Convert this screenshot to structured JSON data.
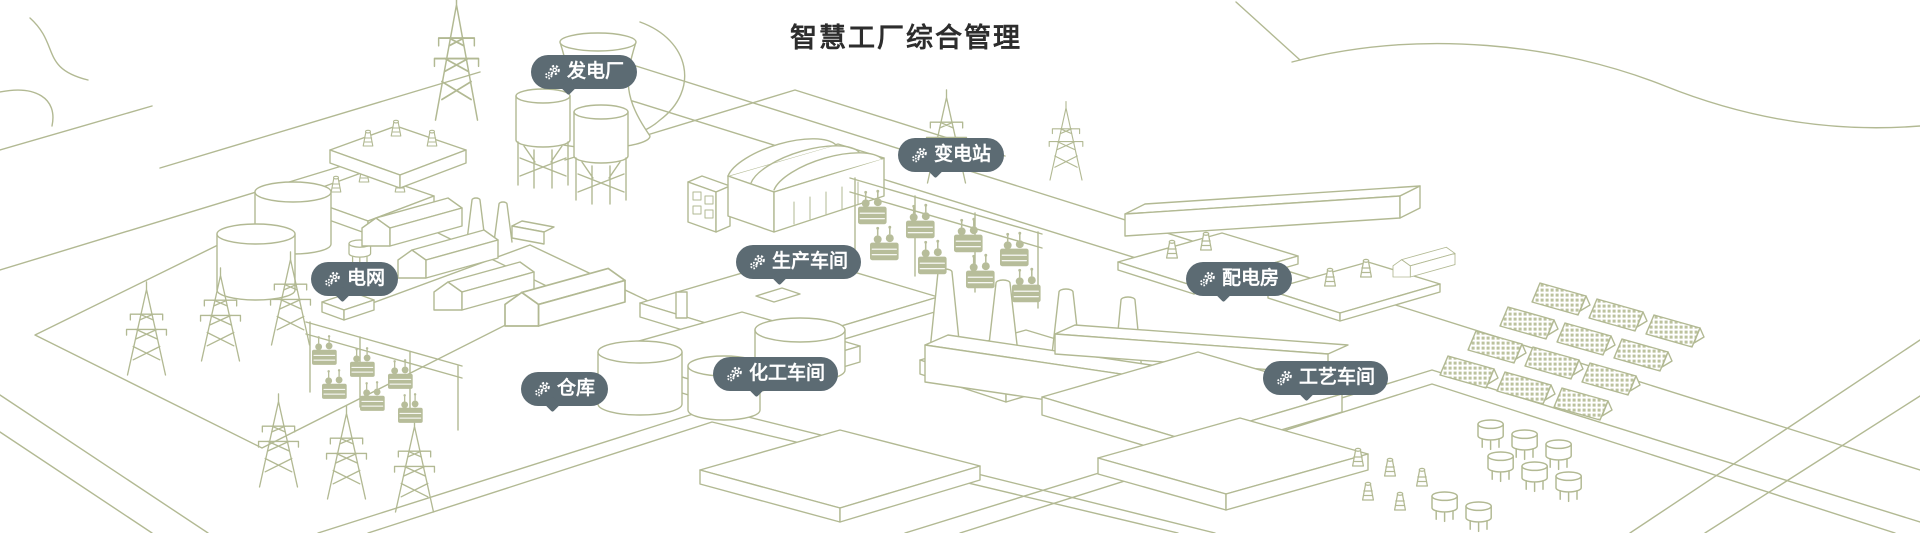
{
  "page": {
    "title": "智慧工厂综合管理"
  },
  "colors": {
    "line_art": "#b2b993",
    "line_art_fill": "#b7bd9a",
    "tag_background": "#5c6b73",
    "tag_text": "#ffffff",
    "title_text": "#2d2d2d",
    "canvas_background": "#ffffff"
  },
  "tags": [
    {
      "label": "发电厂",
      "icon": "gears-icon"
    },
    {
      "label": "变电站",
      "icon": "gears-icon"
    },
    {
      "label": "电网",
      "icon": "gears-icon"
    },
    {
      "label": "生产车间",
      "icon": "gears-icon"
    },
    {
      "label": "配电房",
      "icon": "gears-icon"
    },
    {
      "label": "仓库",
      "icon": "gears-icon"
    },
    {
      "label": "化工车间",
      "icon": "gears-icon"
    },
    {
      "label": "工艺车间",
      "icon": "gears-icon"
    }
  ],
  "scene": {
    "elements": [
      "transmission-towers",
      "cooling-tower",
      "silos",
      "storage-tanks",
      "transformer-yards",
      "warehouse-sheds",
      "production-hall",
      "factory-slabs",
      "chemical-tanks",
      "smokestacks",
      "distribution-pads",
      "solar-panel-array",
      "roads"
    ]
  }
}
